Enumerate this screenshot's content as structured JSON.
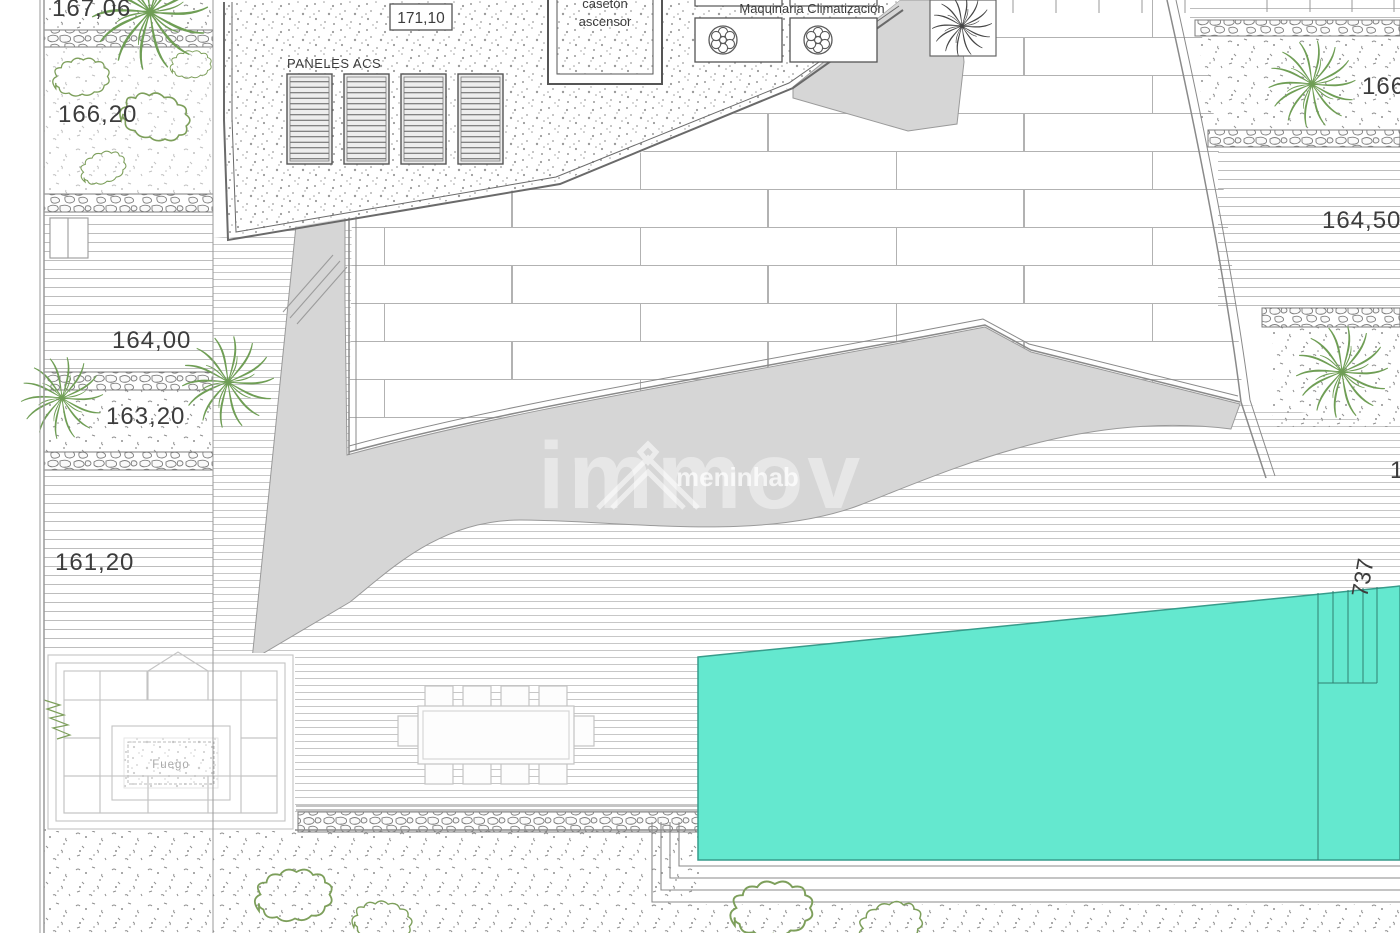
{
  "drawing": {
    "title": "villa site plan",
    "labels": {
      "elev_left_top": "167,06",
      "elev_left_2": "166,20",
      "elev_left_3": "164,00",
      "elev_left_4": "163,20",
      "elev_left_5": "161,20",
      "roof_level": "171,10",
      "solar_panels": "PANELES ACS",
      "elevator_line1": "casetón",
      "elevator_line2": "ascensor",
      "hvac": "Maquinaria Climatización",
      "elev_right_top": "166",
      "elev_right_2": "164,50",
      "elev_right_partial": "1",
      "pool_dim": "737",
      "fire_pit": "Fuego"
    },
    "watermark": {
      "brand": "immov",
      "sub": "meninhab"
    },
    "colors": {
      "pool": "#64E8CF",
      "pool_edge": "#379c8b",
      "ramp_gray": "#d6d6d6",
      "plant_green": "#6f9e55",
      "line_gray": "#8a8a8a",
      "text": "#3c3c3c"
    }
  }
}
